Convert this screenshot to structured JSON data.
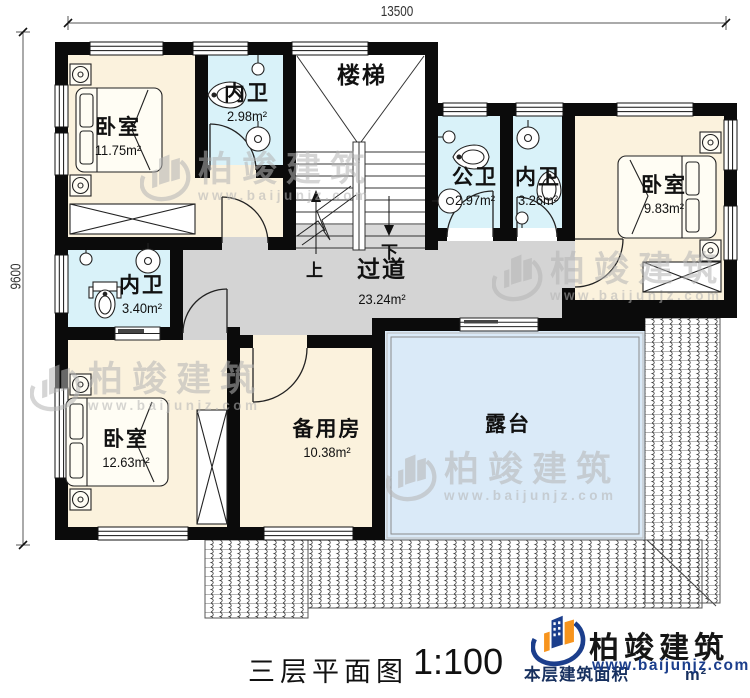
{
  "dimensions": {
    "width_label": "13500",
    "height_label": "9600"
  },
  "rooms": {
    "bedroom_tl": {
      "name": "卧室",
      "area": "11.75m²"
    },
    "bath_tl": {
      "name": "内卫",
      "area": "2.98m²"
    },
    "stairs": {
      "name": "楼梯"
    },
    "public_bath": {
      "name": "公卫",
      "area": "2.97m²"
    },
    "bath_tr": {
      "name": "内卫",
      "area": "3.26m²"
    },
    "bedroom_tr": {
      "name": "卧室",
      "area": "9.83m²"
    },
    "bath_ml": {
      "name": "内卫",
      "area": "3.40m²"
    },
    "corridor": {
      "name": "过道",
      "area": "23.24m²"
    },
    "bedroom_bl": {
      "name": "卧室",
      "area": "12.63m²"
    },
    "spare_room": {
      "name": "备用房",
      "area": "10.38m²"
    },
    "terrace": {
      "name": "露台"
    }
  },
  "stairs_annotations": {
    "up": "上",
    "down": "下"
  },
  "watermark": {
    "brand": "柏竣建筑",
    "url": "www.baijunjz.com"
  },
  "footer": {
    "plan_title": "三层平面图",
    "scale": "1:100",
    "area_note_prefix": "本层建筑面积",
    "area_note_suffix": "m²",
    "brand": "柏竣建筑",
    "url": "www.baijunjz.com"
  },
  "colors": {
    "wall": "#0b0b0b",
    "bedroom_fill": "#fbf2dd",
    "bath_fill": "#d9f2f9",
    "corridor_fill": "#d4d4d4",
    "terrace_fill": "#daeaf8",
    "brand_blue": "#1b3e8c",
    "brand_orange": "#f7941d"
  }
}
